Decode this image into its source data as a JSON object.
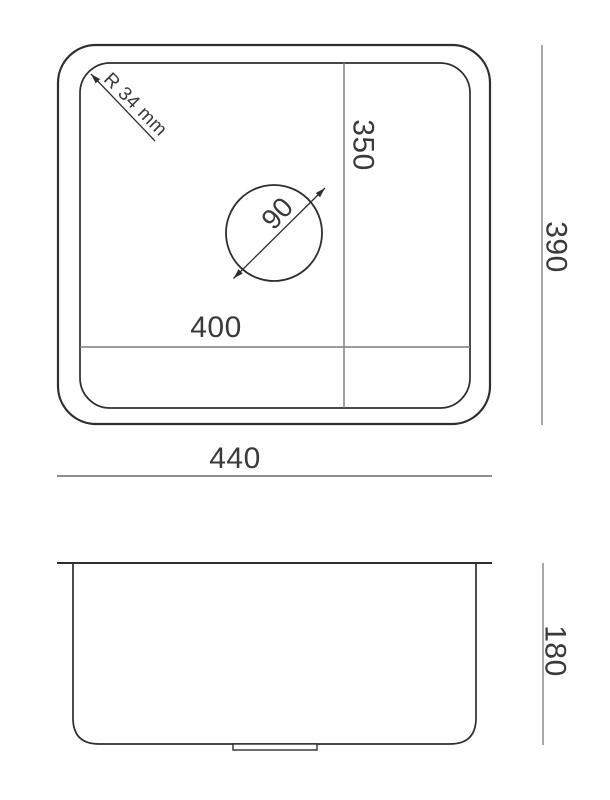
{
  "drawing": {
    "type": "sink-technical-drawing",
    "top_view": {
      "dimensions": {
        "corner_radius_label": "R 34 mm",
        "drain_diameter": "90",
        "bowl_width": "400",
        "bowl_depth": "350",
        "overall_width": "440",
        "overall_depth": "390"
      }
    },
    "side_view": {
      "dimensions": {
        "overall_height": "180"
      }
    },
    "colors": {
      "outline": "#2e2e2e",
      "interior_line": "#7a7a7a",
      "dimension_line": "#8f8f8f",
      "text": "#3a3a3a",
      "background": "#ffffff"
    }
  }
}
